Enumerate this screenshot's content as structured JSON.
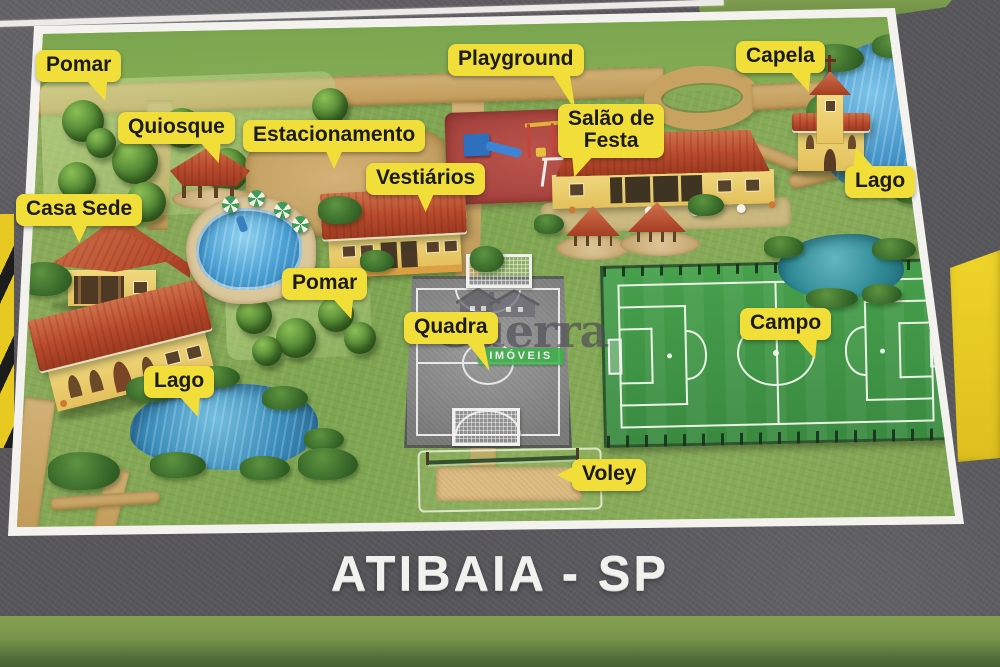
{
  "title": "ATIBAIA - SP",
  "watermark": {
    "brand": "Guerra",
    "tagline": "IMÓVEIS",
    "icon": "twin-houses-logo"
  },
  "labels": {
    "pomar_top": "Pomar",
    "quiosque": "Quiosque",
    "estacionamento": "Estacionamento",
    "playground": "Playground",
    "capela": "Capela",
    "salao_de_festa_line1": "Salão de",
    "salao_de_festa_line2": "Festa",
    "lago_top_right": "Lago",
    "casa_sede": "Casa Sede",
    "vestiarios": "Vestiários",
    "pomar_mid": "Pomar",
    "quadra": "Quadra",
    "campo": "Campo",
    "lago_bottom_left": "Lago",
    "voley": "Voley"
  },
  "colors": {
    "label_bg": "#f2de39",
    "label_text": "#1b1b1b",
    "asphalt": "#56555a",
    "grass": "#84a553",
    "dirt_road": "#c7a261",
    "field_green": "#3f9746",
    "water_blue": "#3e8fc6",
    "roof_red": "#b5452c",
    "curb_yellow": "#e8c922",
    "watermark_green": "#3cb149",
    "title_color": "#f1f1ed"
  }
}
